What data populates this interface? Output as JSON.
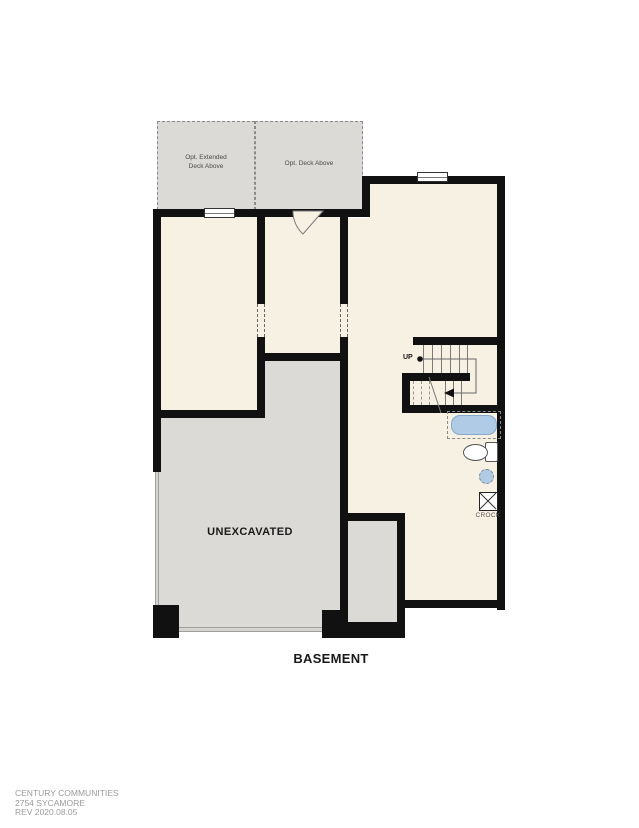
{
  "document": {
    "title": "BASEMENT",
    "footer": {
      "company": "CENTURY COMMUNITIES",
      "plan_name": "2754 SYCAMORE",
      "revision": "REV 2020.08.05"
    }
  },
  "floorplan": {
    "rooms": {
      "unexcavated": "UNEXCAVATED",
      "stairs_up": "UP",
      "crock": "CROCK"
    },
    "decks": {
      "left_line1": "Opt. Extended",
      "left_line2": "Deck Above",
      "right": "Opt. Deck Above"
    },
    "fixtures": [
      "tub",
      "toilet",
      "sink-rough-in",
      "crock-pit"
    ],
    "colors": {
      "wall": "#111111",
      "room": "#f6f1e3",
      "unexcavated": "#dcdad6",
      "deck": "#dcdad6",
      "plumbing_blue": "#b0cbe5",
      "dashed_gray": "#8a8a8a",
      "footer_text": "#9b9b9b"
    }
  }
}
